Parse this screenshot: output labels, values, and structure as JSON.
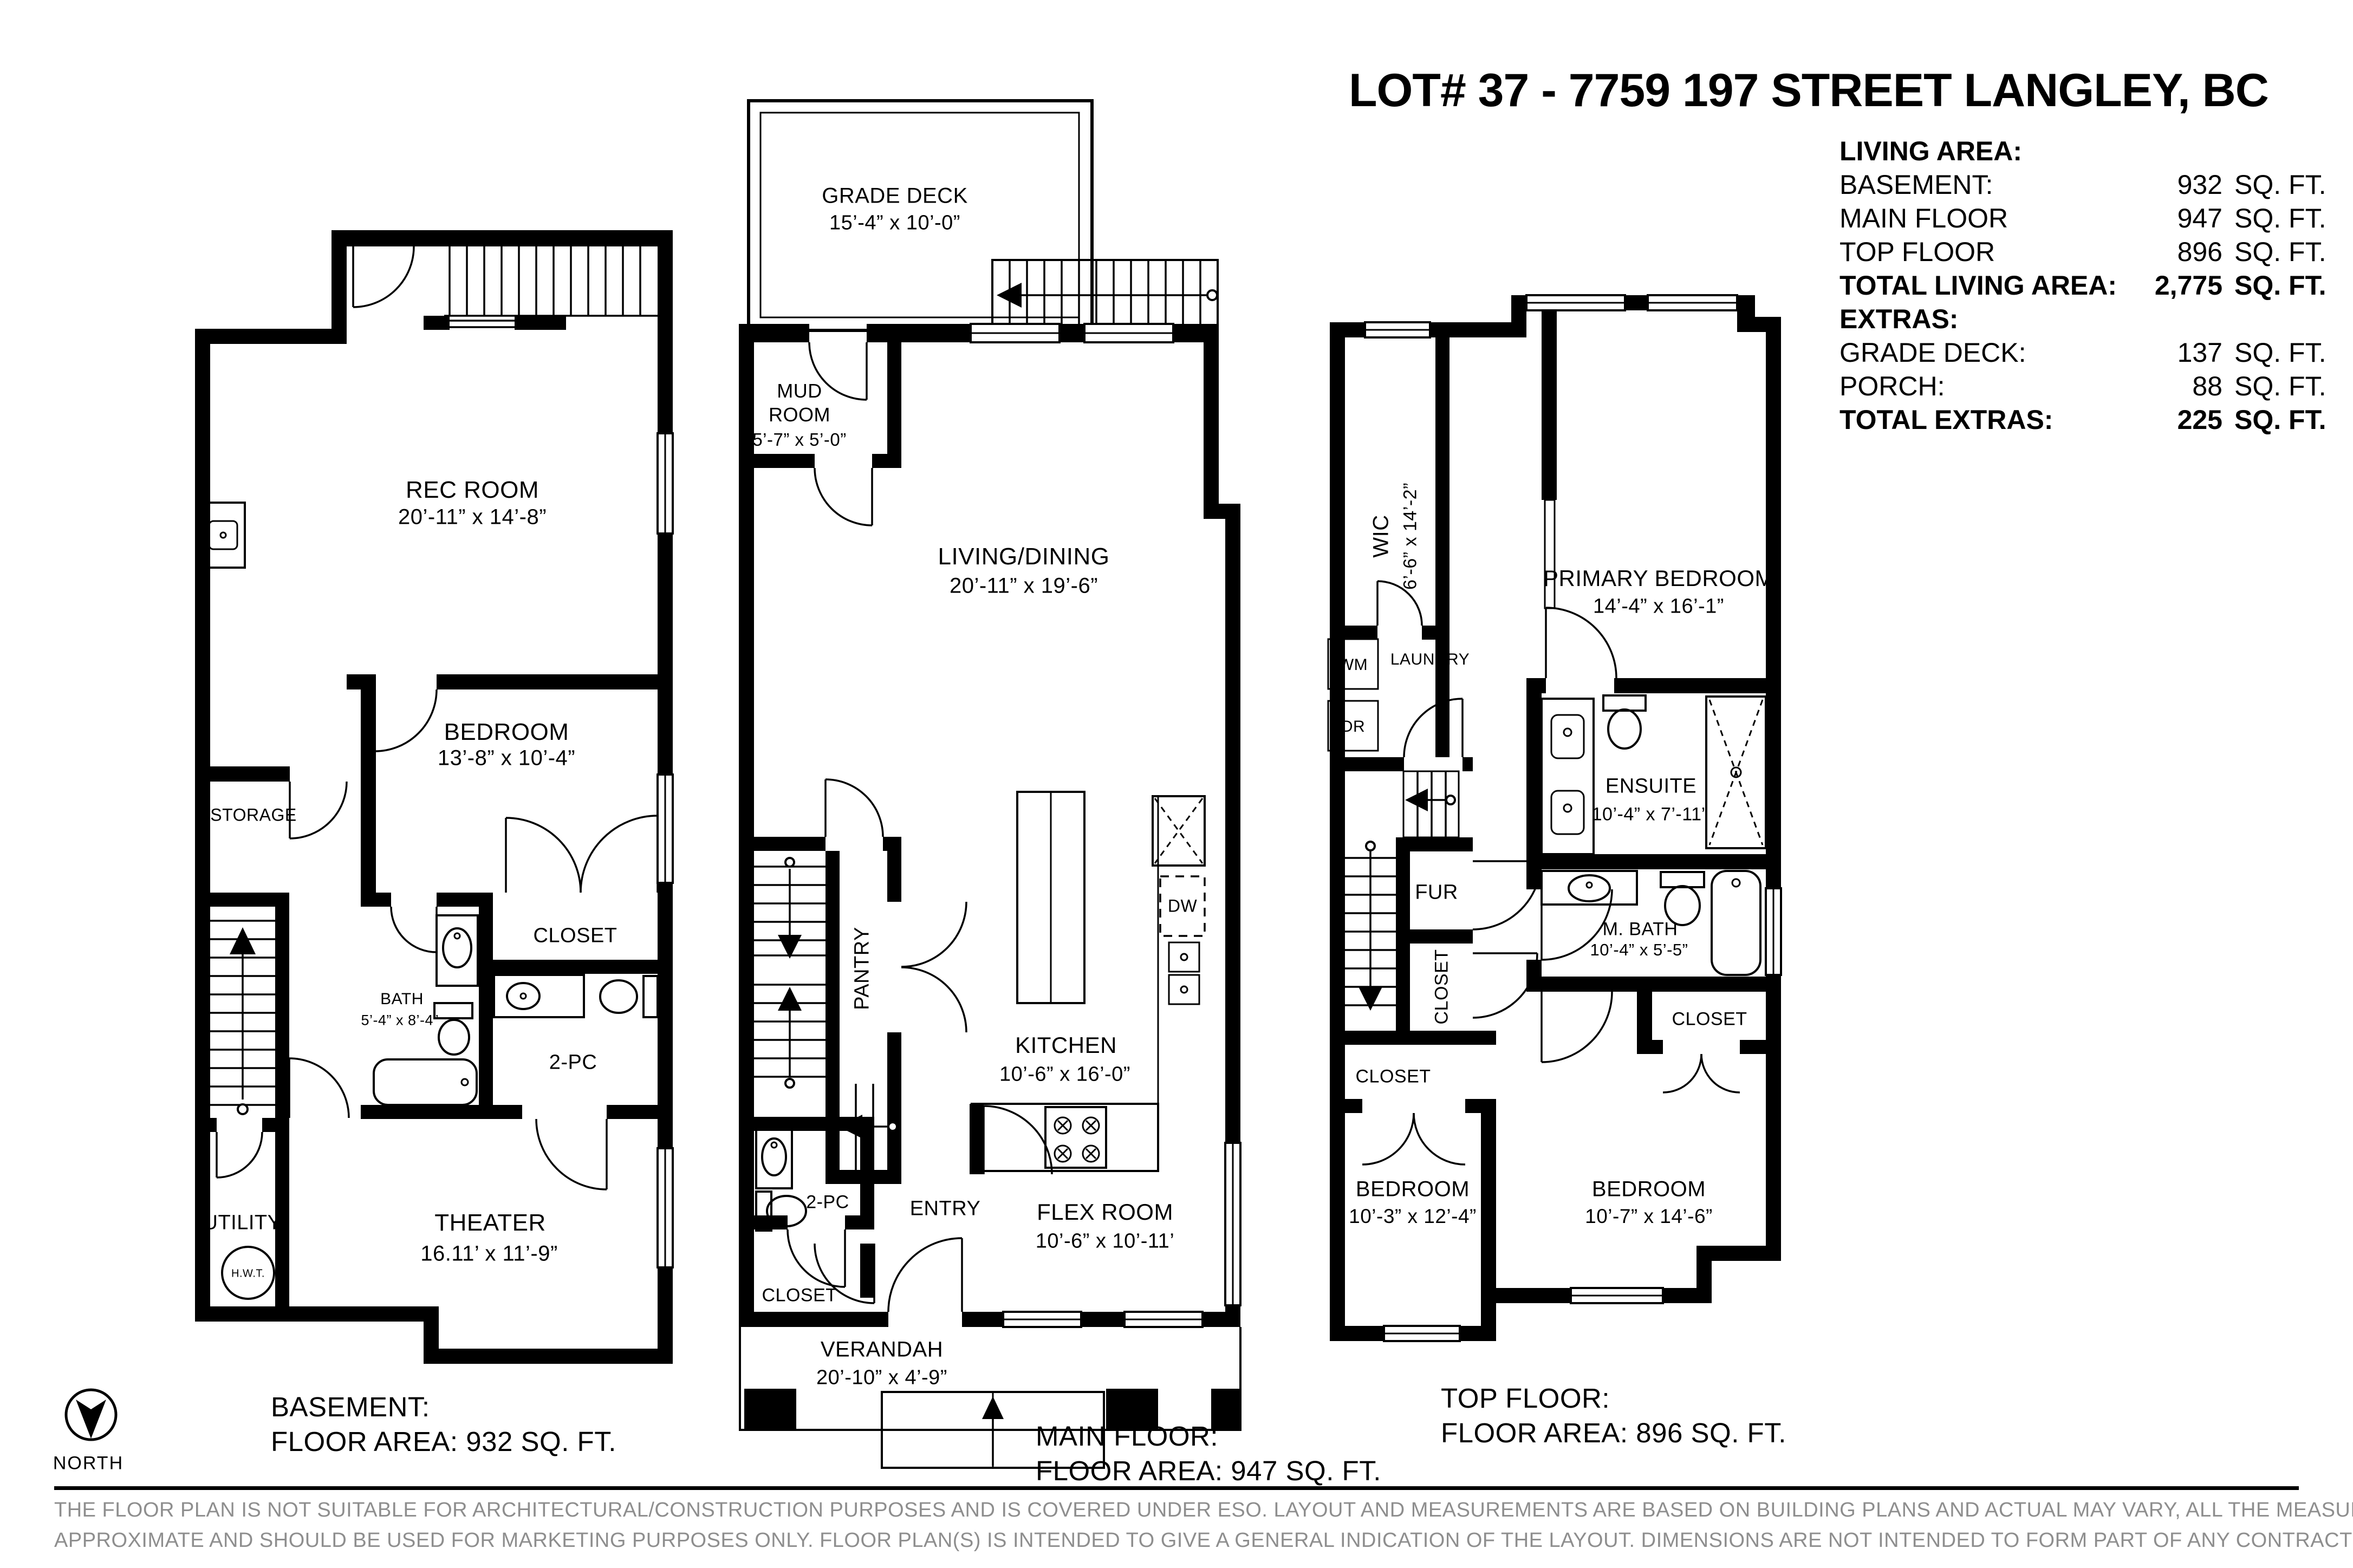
{
  "title": "LOT# 37 - 7759 197 STREET LANGLEY, BC",
  "area_table": {
    "heading": "LIVING AREA:",
    "rows": [
      {
        "label": "BASEMENT:",
        "value": "932",
        "unit": "SQ. FT."
      },
      {
        "label": "MAIN FLOOR",
        "value": "947",
        "unit": "SQ. FT."
      },
      {
        "label": "TOP FLOOR",
        "value": "896",
        "unit": "SQ. FT."
      },
      {
        "label": "TOTAL LIVING AREA:",
        "value": "2,775",
        "unit": "SQ. FT."
      },
      {
        "label": "EXTRAS:",
        "value": "",
        "unit": ""
      },
      {
        "label": "GRADE DECK:",
        "value": "137",
        "unit": "SQ. FT."
      },
      {
        "label": "PORCH:",
        "value": "88",
        "unit": "SQ. FT."
      },
      {
        "label": "TOTAL EXTRAS:",
        "value": "225",
        "unit": "SQ. FT."
      }
    ]
  },
  "basement": {
    "caption_line1": "BASEMENT:",
    "caption_line2": "FLOOR AREA: 932 SQ. FT.",
    "rooms": {
      "rec_room": {
        "name": "REC ROOM",
        "dims": "20’-11” x 14’-8”"
      },
      "bedroom": {
        "name": "BEDROOM",
        "dims": "13’-8” x 10’-4”"
      },
      "storage": {
        "name": "STORAGE"
      },
      "bath": {
        "name": "BATH",
        "dims": "5’-4” x 8’-4”"
      },
      "closet": {
        "name": "CLOSET"
      },
      "twopc": {
        "name": "2-PC"
      },
      "theater": {
        "name": "THEATER",
        "dims": "16.11’ x 11’-9”"
      },
      "utility": {
        "name": "UTILITY"
      },
      "hwt": {
        "name": "H.W.T."
      }
    }
  },
  "main_floor": {
    "caption_line1": "MAIN FLOOR:",
    "caption_line2": "FLOOR AREA: 947 SQ. FT.",
    "rooms": {
      "grade_deck": {
        "name": "GRADE DECK",
        "dims": "15’-4” x 10’-0”"
      },
      "mud_room": {
        "line1": "MUD",
        "line2": "ROOM",
        "dims": "5’-7” x 5’-0”"
      },
      "living_dining": {
        "name": "LIVING/DINING",
        "dims": "20’-11” x 19’-6”"
      },
      "pantry": {
        "name": "PANTRY"
      },
      "kitchen": {
        "name": "KITCHEN",
        "dims": "10’-6” x 16’-0”"
      },
      "dw": {
        "name": "DW"
      },
      "twopc": {
        "name": "2-PC"
      },
      "entry": {
        "name": "ENTRY"
      },
      "closet": {
        "name": "CLOSET"
      },
      "flex_room": {
        "name": "FLEX ROOM",
        "dims": "10’-6” x 10’-11’"
      },
      "verandah": {
        "name": "VERANDAH",
        "dims": "20’-10” x 4’-9”"
      }
    }
  },
  "top_floor": {
    "caption_line1": "TOP FLOOR:",
    "caption_line2": "FLOOR AREA: 896 SQ. FT.",
    "rooms": {
      "wic": {
        "name": "WIC",
        "dims": "6’-6” x 14’-2”"
      },
      "primary_bedroom": {
        "name": "PRIMARY BEDROOM",
        "dims": "14’-4” x 16’-1”"
      },
      "laundry": {
        "name": "LAUNDRY"
      },
      "wm": {
        "name": "WM"
      },
      "dr": {
        "name": "DR"
      },
      "fur": {
        "name": "FUR"
      },
      "closet_mid": {
        "name": "CLOSET"
      },
      "ensuite": {
        "name": "ENSUITE",
        "dims": "10’-4” x 7’-11”"
      },
      "mbath": {
        "name": "M. BATH",
        "dims": "10’-4” x 5’-5”"
      },
      "closet_right": {
        "name": "CLOSET"
      },
      "closet_left": {
        "name": "CLOSET"
      },
      "bedroom_left": {
        "name": "BEDROOM",
        "dims": "10’-3” x 12’-4”"
      },
      "bedroom_right": {
        "name": "BEDROOM",
        "dims": "10’-7” x 14’-6”"
      }
    }
  },
  "north": {
    "label": "NORTH"
  },
  "disclaimer": {
    "line1": "THE FLOOR PLAN IS NOT SUITABLE FOR ARCHITECTURAL/CONSTRUCTION PURPOSES AND IS COVERED UNDER ESO. LAYOUT AND MEASUREMENTS ARE BASED ON BUILDING PLANS AND ACTUAL MAY VARY, ALL THE MEASUREMENTS SHOULD BE CONSIDERED",
    "line2": "APPROXIMATE AND SHOULD BE USED FOR MARKETING PURPOSES ONLY. FLOOR PLAN(S) IS INTENDED TO GIVE A GENERAL INDICATION OF THE LAYOUT. DIMENSIONS ARE NOT INTENDED TO FORM PART OF ANY CONTRACT OR WARRANTY."
  }
}
